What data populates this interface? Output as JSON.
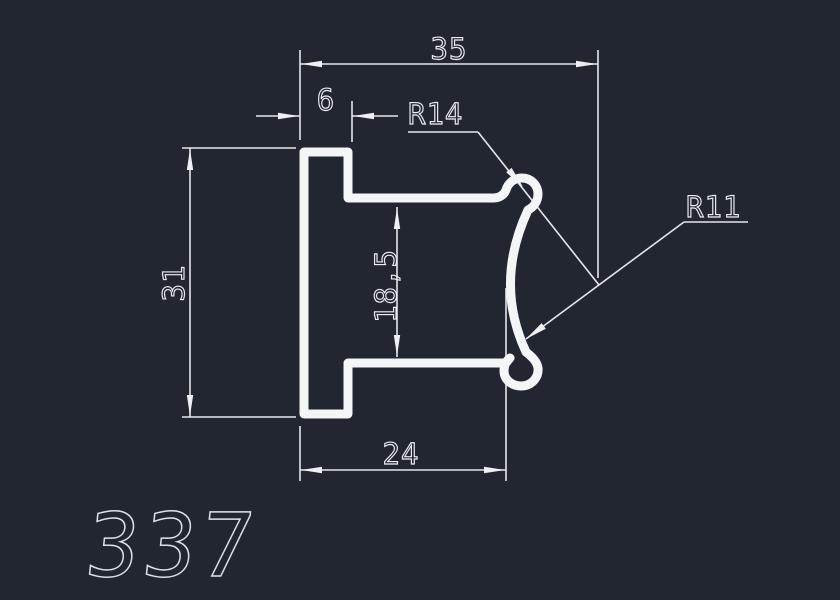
{
  "drawing": {
    "part_number": "337",
    "dimensions": {
      "overall_width": "35",
      "tongue_width": "6",
      "overall_height": "31",
      "inner_gap": "18,5",
      "bottom_width": "24",
      "radius_top": "R14",
      "radius_side": "R11"
    },
    "colors": {
      "background": "#212631",
      "profile_line": "#f3f5f7",
      "dimension_line": "#e4e7eb",
      "text": "#eaedf0"
    }
  }
}
